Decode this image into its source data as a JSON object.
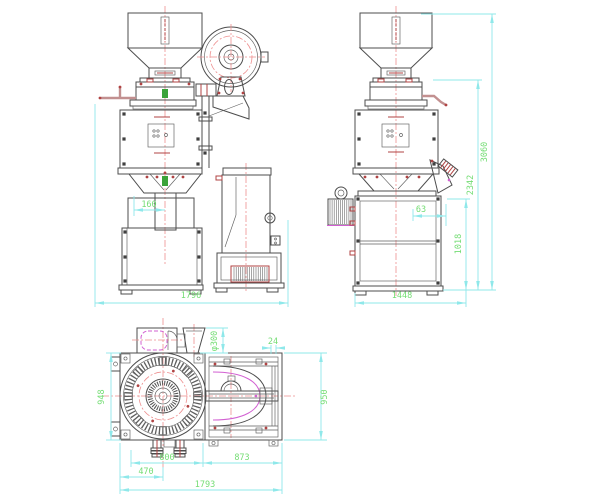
{
  "drawing": {
    "views": {
      "front": {
        "dims": {
          "spout_offset": "160",
          "overall_width": "1796"
        }
      },
      "side": {
        "dims": {
          "chute_offset": "63",
          "base_height": "1018",
          "mill_height": "2342",
          "overall_height": "3060",
          "overall_depth": "1448"
        }
      },
      "top": {
        "dims": {
          "duct_diameter": "φ300",
          "edge_gap": "24",
          "left_depth": "948",
          "right_depth": "950",
          "center_width": "800",
          "spout_offset": "470",
          "right_width": "873",
          "overall_width": "1793"
        }
      }
    },
    "colors": {
      "background": "#ffffff",
      "outline": "#4d4d4d",
      "centerline": "#ee8f8f",
      "dimension_line": "#8fe8ea",
      "dimension_text": "#74dd74",
      "detail_red": "#b04343",
      "detail_magenta": "#d260d2",
      "detail_green": "#3aa33a",
      "pipe": "#c29090"
    }
  }
}
